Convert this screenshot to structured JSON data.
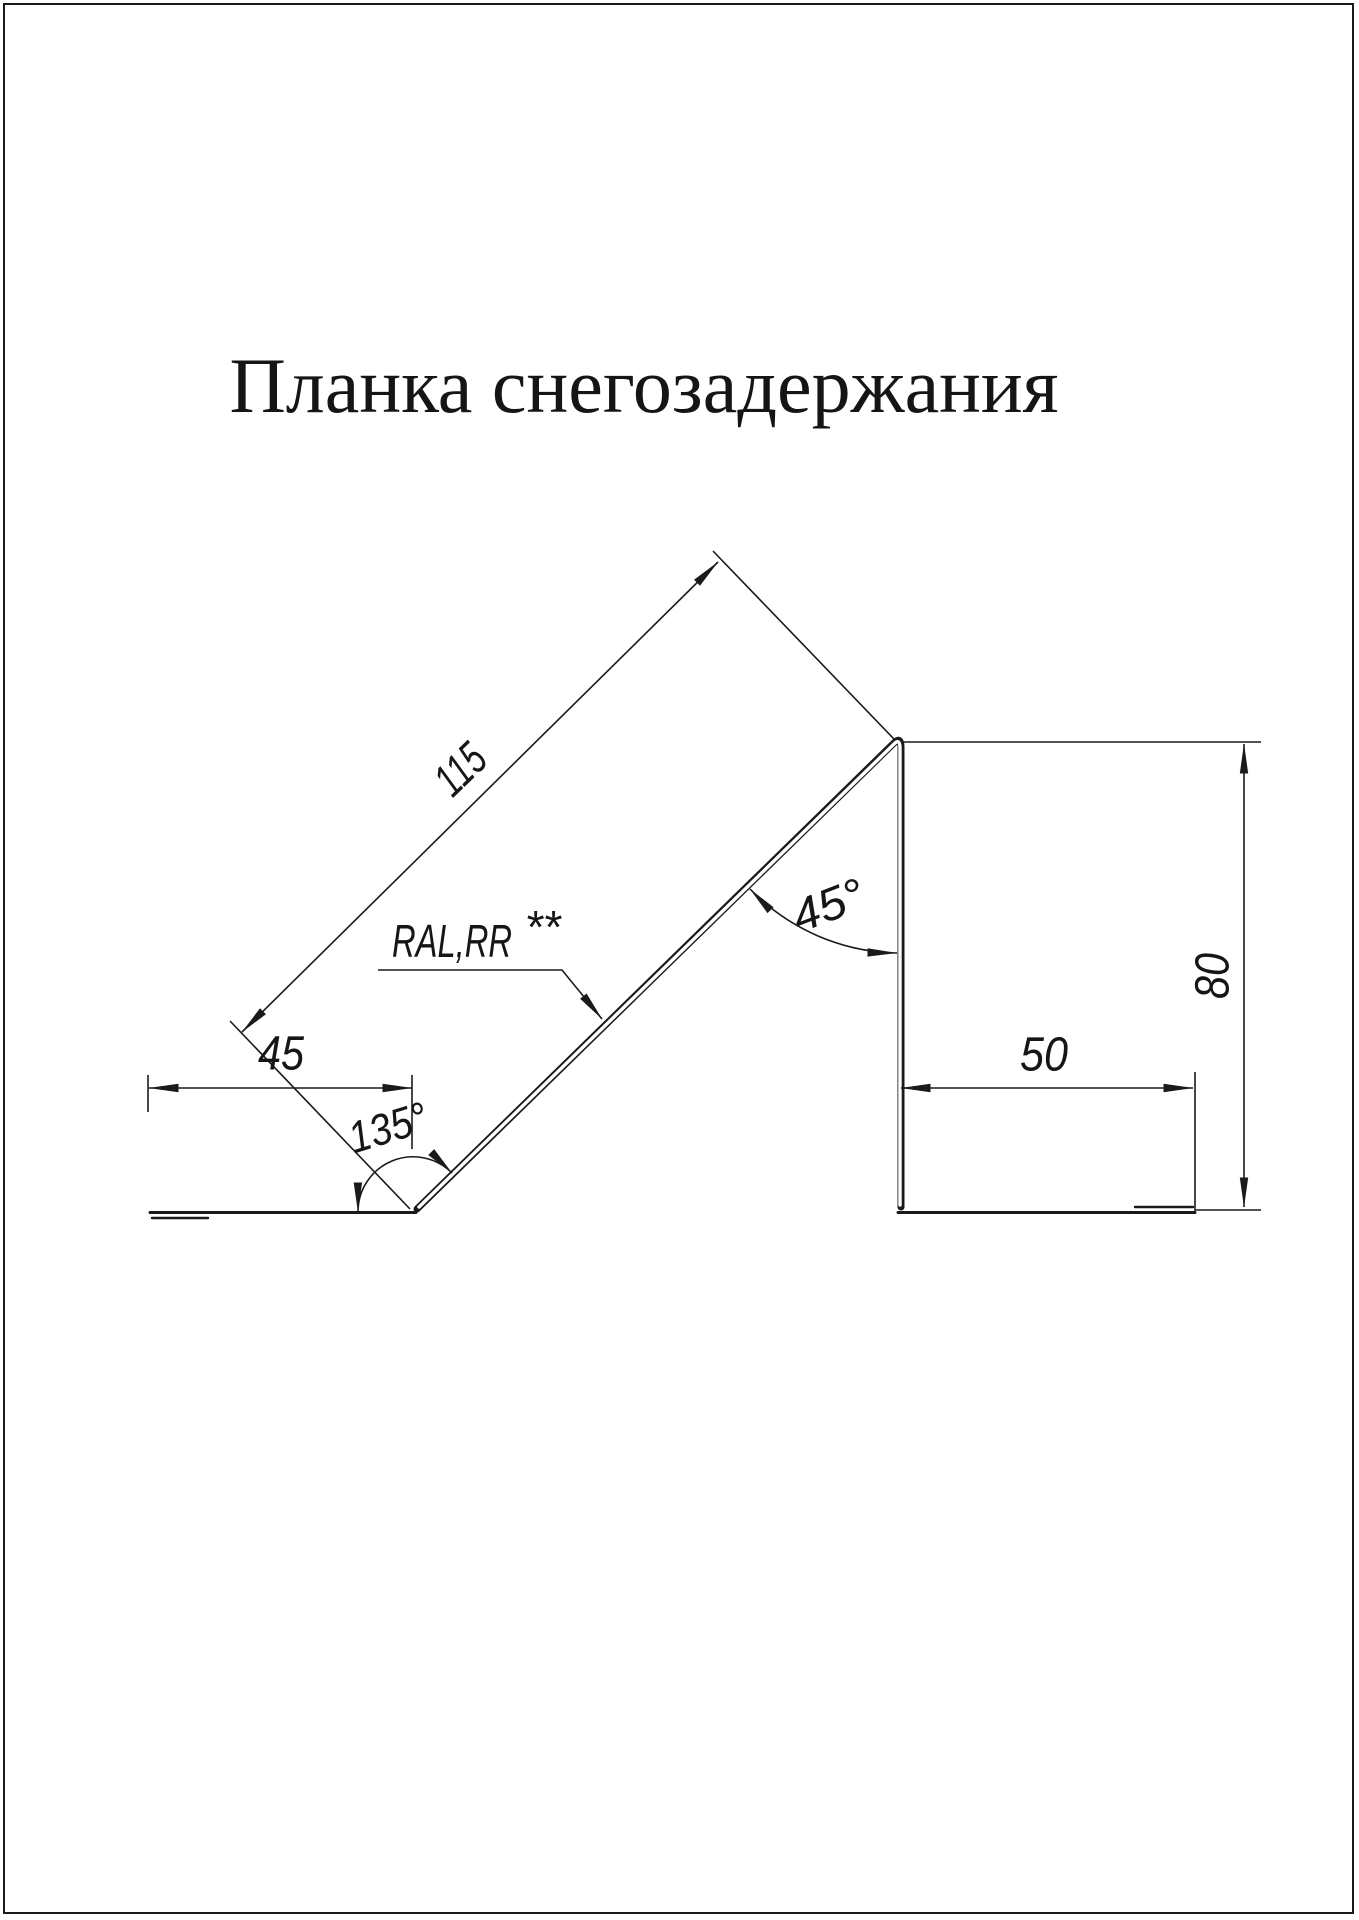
{
  "page": {
    "title": "Планка снегозадержания"
  },
  "drawing": {
    "name": "snow-retention-bar-profile",
    "dimensions": {
      "incline_length": "115",
      "left_foot_width": "45",
      "right_foot_width": "50",
      "height": "80",
      "top_angle": "45°",
      "bottom_angle": "135°"
    },
    "material_label": {
      "text": "RAL,RR",
      "superscript": "**"
    },
    "colors": {
      "line": "#1a1a1a",
      "background": "#ffffff"
    }
  }
}
